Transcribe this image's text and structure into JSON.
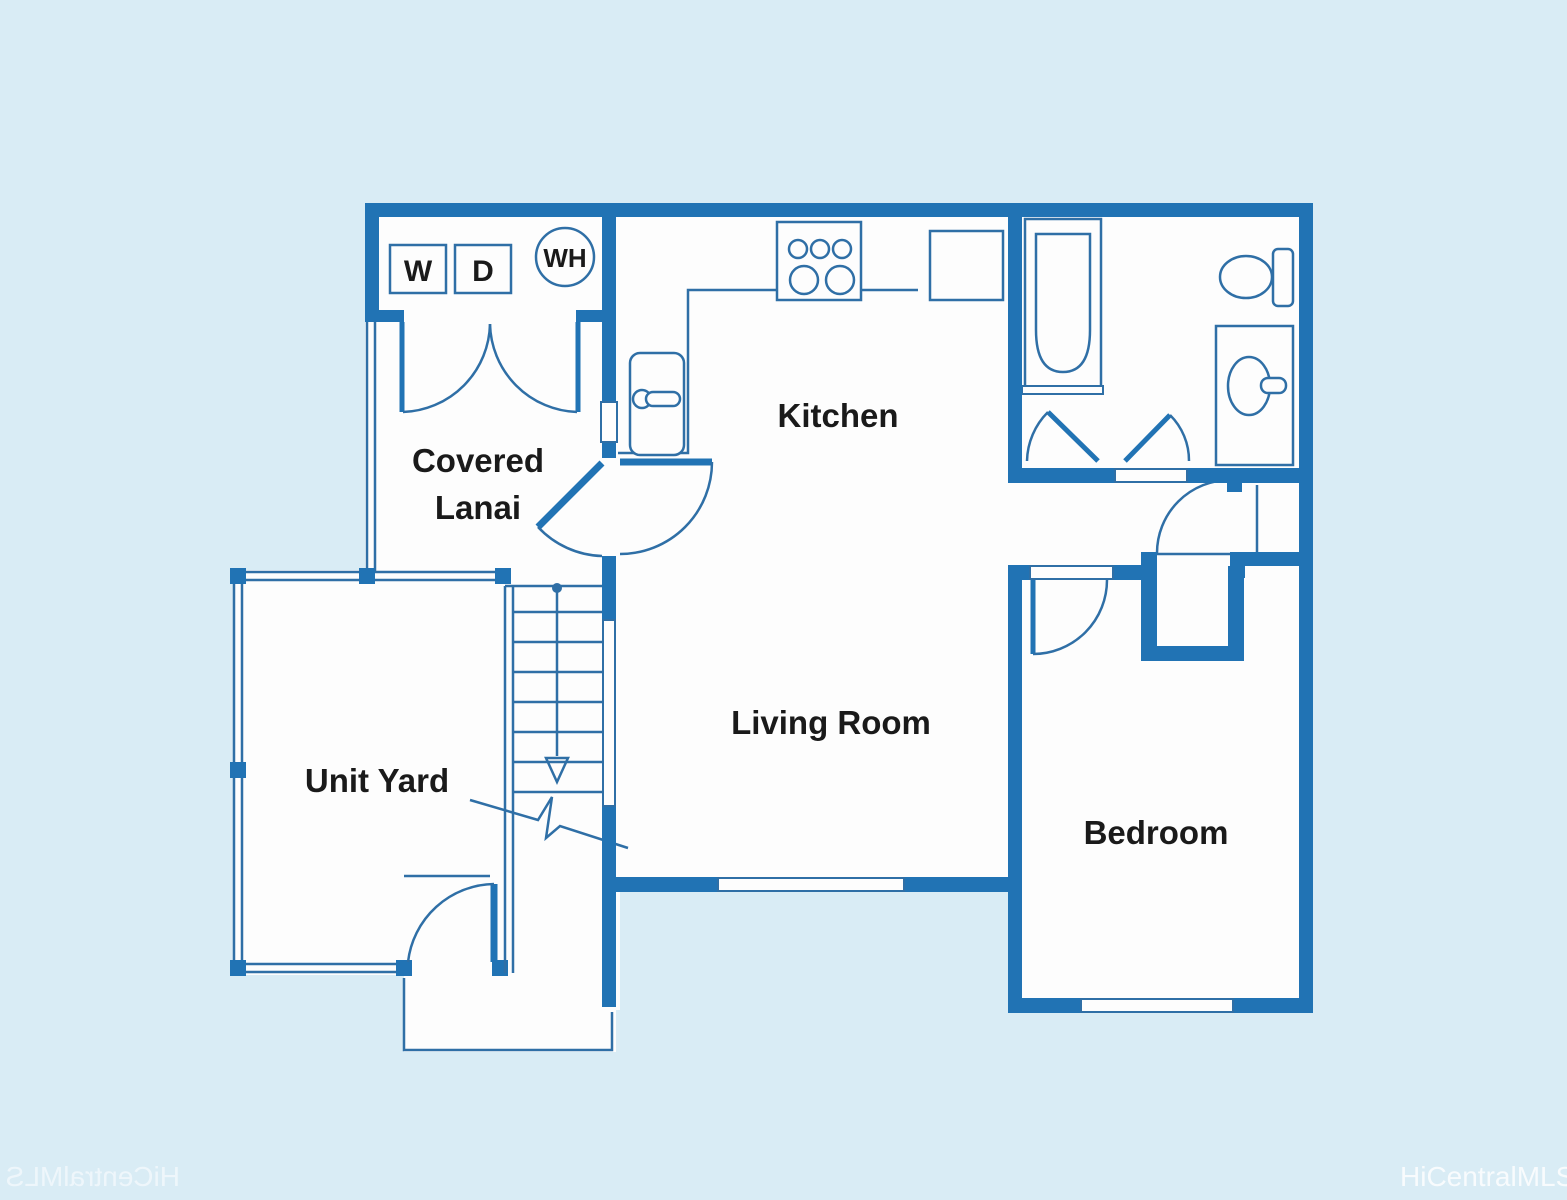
{
  "floor_plan": {
    "colors": {
      "background": "#d9ecf5",
      "wall": "#2173b4",
      "thin_line": "#2f6fa6",
      "interior": "#fdfdfd",
      "label_text": "#1a1a1a",
      "watermark": "rgba(255,255,255,0.8)"
    },
    "rooms": {
      "covered_lanai_line1": "Covered",
      "covered_lanai_line2": "Lanai",
      "kitchen": "Kitchen",
      "living_room": "Living Room",
      "bedroom": "Bedroom",
      "unit_yard": "Unit Yard"
    },
    "appliances": {
      "washer": "W",
      "dryer": "D",
      "water_heater": "WH"
    },
    "fixtures": [
      "stove",
      "refrigerator",
      "kitchen-sink",
      "bathtub",
      "toilet",
      "vanity-sink",
      "stairs-down",
      "yard-fence",
      "gate-door",
      "windows",
      "doors"
    ],
    "watermark": {
      "bottom_left": "HiCentralMLS",
      "bottom_right": "HiCentralMLS"
    }
  }
}
